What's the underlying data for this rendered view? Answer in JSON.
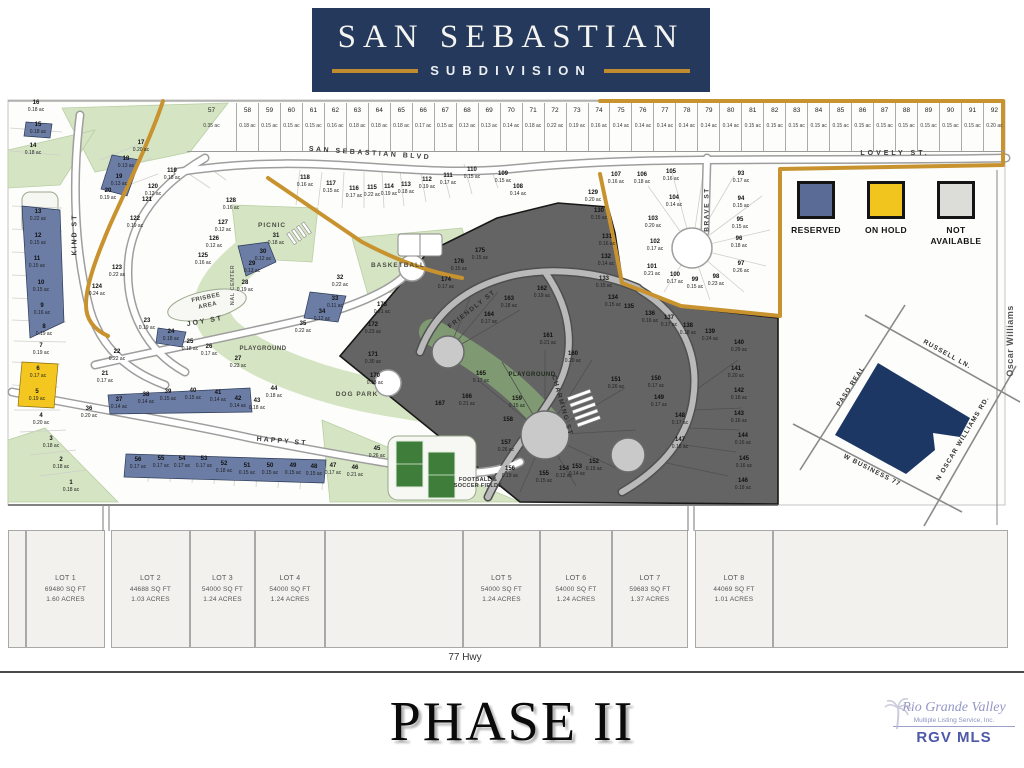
{
  "header": {
    "title": "SAN SEBASTIAN",
    "subtitle": "SUBDIVISION"
  },
  "legend": {
    "items": [
      {
        "label": "RESERVED",
        "color": "#5a6b96"
      },
      {
        "label": "ON HOLD",
        "color": "#f2c51e"
      },
      {
        "label": "NOT AVAILABLE",
        "color": "#dcdcd9"
      }
    ]
  },
  "map": {
    "streets": {
      "san_sebastian": "SAN SEBASTIAN BLVD",
      "lovely": "LOVELY ST.",
      "kind": "KIND ST",
      "joy": "JOY ST",
      "happy": "HAPPY ST",
      "friendly": "FRIENDLY ST",
      "charming": "CHARMING ST",
      "brave": "BRAVE ST",
      "oscar_williams": "Oscar Williams"
    },
    "amenities": {
      "picnic": "PICNIC",
      "center": "NAL CENTER",
      "basketball": "BASKETBALL",
      "frisbee": "FRISBEE AREA",
      "playground_w": "PLAYGROUND",
      "playground_e": "PLAYGROUND",
      "dog_park": "DOG PARK",
      "fields": "FOOTBALL & SOCCER FIELDS"
    },
    "top_lots": [
      {
        "n": 57,
        "ac": "0.35 ac"
      },
      {
        "n": 58,
        "ac": "0.18 ac"
      },
      {
        "n": 59,
        "ac": "0.15 ac"
      },
      {
        "n": 60,
        "ac": "0.15 ac"
      },
      {
        "n": 61,
        "ac": "0.15 ac"
      },
      {
        "n": 62,
        "ac": "0.16 ac"
      },
      {
        "n": 63,
        "ac": "0.18 ac"
      },
      {
        "n": 64,
        "ac": "0.18 ac"
      },
      {
        "n": 65,
        "ac": "0.18 ac"
      },
      {
        "n": 66,
        "ac": "0.17 ac"
      },
      {
        "n": 67,
        "ac": "0.15 ac"
      },
      {
        "n": 68,
        "ac": "0.13 ac"
      },
      {
        "n": 69,
        "ac": "0.13 ac"
      },
      {
        "n": 70,
        "ac": "0.14 ac"
      },
      {
        "n": 71,
        "ac": "0.18 ac"
      },
      {
        "n": 72,
        "ac": "0.22 ac"
      },
      {
        "n": 73,
        "ac": "0.19 ac"
      },
      {
        "n": 74,
        "ac": "0.16 ac"
      },
      {
        "n": 75,
        "ac": "0.14 ac"
      },
      {
        "n": 76,
        "ac": "0.14 ac"
      },
      {
        "n": 77,
        "ac": "0.14 ac"
      },
      {
        "n": 78,
        "ac": "0.14 ac"
      },
      {
        "n": 79,
        "ac": "0.14 ac"
      },
      {
        "n": 80,
        "ac": "0.14 ac"
      },
      {
        "n": 81,
        "ac": "0.15 ac"
      },
      {
        "n": 82,
        "ac": "0.15 ac"
      },
      {
        "n": 83,
        "ac": "0.15 ac"
      },
      {
        "n": 84,
        "ac": "0.15 ac"
      },
      {
        "n": 85,
        "ac": "0.15 ac"
      },
      {
        "n": 86,
        "ac": "0.15 ac"
      },
      {
        "n": 87,
        "ac": "0.15 ac"
      },
      {
        "n": 88,
        "ac": "0.15 ac"
      },
      {
        "n": 89,
        "ac": "0.15 ac"
      },
      {
        "n": 90,
        "ac": "0.15 ac"
      },
      {
        "n": 91,
        "ac": "0.15 ac"
      },
      {
        "n": 92,
        "ac": "0.20 ac"
      }
    ],
    "lots": [
      [
        16,
        "0.18 ac",
        36,
        107,
        "w"
      ],
      [
        15,
        "0.18 ac",
        38,
        129,
        "b"
      ],
      [
        14,
        "0.18 ac",
        33,
        150,
        "w"
      ],
      [
        13,
        "0.22 ac",
        38,
        216,
        "b"
      ],
      [
        12,
        "0.15 ac",
        38,
        240,
        "b"
      ],
      [
        11,
        "0.15 ac",
        37,
        263,
        "b"
      ],
      [
        10,
        "0.15 ac",
        41,
        287,
        "b"
      ],
      [
        9,
        "0.16 ac",
        42,
        310,
        "b"
      ],
      [
        8,
        "0.19 ac",
        44,
        331,
        "w"
      ],
      [
        7,
        "0.19 ac",
        41,
        350,
        "w"
      ],
      [
        6,
        "0.17 ac",
        38,
        373,
        "y"
      ],
      [
        5,
        "0.19 ac",
        37,
        396,
        "y"
      ],
      [
        4,
        "0.20 ac",
        41,
        420,
        "w"
      ],
      [
        3,
        "0.18 ac",
        51,
        443,
        "w"
      ],
      [
        2,
        "0.18 ac",
        61,
        464,
        "w"
      ],
      [
        1,
        "0.18 ac",
        71,
        487,
        "w"
      ],
      [
        17,
        "0.20 ac",
        141,
        147,
        "w"
      ],
      [
        18,
        "0.13 ac",
        126,
        163,
        "b"
      ],
      [
        19,
        "0.13 ac",
        119,
        181,
        "b"
      ],
      [
        20,
        "0.19 ac",
        108,
        195,
        "w"
      ],
      [
        119,
        "0.18 ac",
        172,
        175,
        "w"
      ],
      [
        120,
        "0.12 ac",
        153,
        191,
        "w"
      ],
      [
        121,
        "",
        147,
        204,
        "w"
      ],
      [
        122,
        "0.19 ac",
        135,
        223,
        "w"
      ],
      [
        123,
        "0.22 ac",
        117,
        272,
        "w"
      ],
      [
        124,
        "0.24 ac",
        97,
        291,
        "w"
      ],
      [
        125,
        "0.16 ac",
        203,
        260,
        "w"
      ],
      [
        126,
        "0.12 ac",
        214,
        243,
        "w"
      ],
      [
        127,
        "0.12 ac",
        223,
        227,
        "w"
      ],
      [
        128,
        "0.16 ac",
        231,
        205,
        "w"
      ],
      [
        22,
        "0.22 ac",
        117,
        356,
        "w"
      ],
      [
        21,
        "0.17 ac",
        105,
        378,
        "w"
      ],
      [
        23,
        "0.19 ac",
        147,
        325,
        "w"
      ],
      [
        24,
        "0.18 ac",
        171,
        336,
        "b"
      ],
      [
        25,
        "0.18 ac",
        190,
        346,
        "w"
      ],
      [
        26,
        "0.17 ac",
        209,
        351,
        "w"
      ],
      [
        27,
        "0.23 ac",
        238,
        363,
        "w"
      ],
      [
        28,
        "0.19 ac",
        245,
        287,
        "w"
      ],
      [
        29,
        "0.13 ac",
        252,
        268,
        "b"
      ],
      [
        30,
        "0.12 ac",
        263,
        256,
        "b"
      ],
      [
        31,
        "0.18 ac",
        276,
        240,
        "w"
      ],
      [
        32,
        "0.22 ac",
        340,
        282,
        "w"
      ],
      [
        33,
        "0.11 ac",
        335,
        303,
        "b"
      ],
      [
        34,
        "0.12 ac",
        322,
        316,
        "b"
      ],
      [
        35,
        "0.22 ac",
        303,
        328,
        "w"
      ],
      [
        36,
        "0.20 ac",
        89,
        413,
        "w"
      ],
      [
        37,
        "0.14 ac",
        119,
        404,
        "b"
      ],
      [
        38,
        "0.14 ac",
        146,
        399,
        "b"
      ],
      [
        39,
        "0.15 ac",
        168,
        396,
        "b"
      ],
      [
        40,
        "0.15 ac",
        193,
        395,
        "b"
      ],
      [
        41,
        "0.14 ac",
        218,
        397,
        "b"
      ],
      [
        42,
        "0.14 ac",
        238,
        403,
        "b"
      ],
      [
        43,
        "0.18 ac",
        257,
        405,
        "w"
      ],
      [
        44,
        "0.18 ac",
        274,
        393,
        "w"
      ],
      [
        45,
        "0.26 ac",
        377,
        453,
        "w"
      ],
      [
        46,
        "0.21 ac",
        355,
        472,
        "w"
      ],
      [
        47,
        "0.17 ac",
        333,
        470,
        "w"
      ],
      [
        48,
        "0.15 ac",
        314,
        471,
        "b"
      ],
      [
        49,
        "0.15 ac",
        293,
        470,
        "b"
      ],
      [
        50,
        "0.15 ac",
        270,
        470,
        "b"
      ],
      [
        51,
        "0.15 ac",
        247,
        470,
        "b"
      ],
      [
        52,
        "0.18 ac",
        224,
        468,
        "b"
      ],
      [
        53,
        "0.17 ac",
        204,
        463,
        "b"
      ],
      [
        54,
        "0.17 ac",
        182,
        463,
        "b"
      ],
      [
        55,
        "0.17 ac",
        161,
        463,
        "b"
      ],
      [
        56,
        "0.17 ac",
        138,
        464,
        "b"
      ],
      [
        118,
        "0.16 ac",
        305,
        182,
        "w"
      ],
      [
        117,
        "0.15 ac",
        331,
        188,
        "w"
      ],
      [
        116,
        "0.17 ac",
        354,
        193,
        "w"
      ],
      [
        115,
        "0.22 ac",
        372,
        192,
        "w"
      ],
      [
        114,
        "0.19 ac",
        389,
        191,
        "w"
      ],
      [
        113,
        "0.18 ac",
        406,
        189,
        "w"
      ],
      [
        112,
        "0.19 ac",
        427,
        184,
        "w"
      ],
      [
        111,
        "0.17 ac",
        448,
        180,
        "w"
      ],
      [
        110,
        "0.15 ac",
        472,
        174,
        "w"
      ],
      [
        109,
        "0.15 ac",
        503,
        178,
        "w"
      ],
      [
        108,
        "0.14 ac",
        518,
        191,
        "w"
      ],
      [
        129,
        "0.20 ac",
        593,
        197,
        "w"
      ],
      [
        130,
        "0.15 ac",
        599,
        215,
        "d"
      ],
      [
        131,
        "0.16 ac",
        607,
        241,
        "d"
      ],
      [
        132,
        "0.14 ac",
        606,
        261,
        "d"
      ],
      [
        133,
        "0.15 ac",
        604,
        283,
        "d"
      ],
      [
        134,
        "0.15 ac",
        613,
        302,
        "d"
      ],
      [
        135,
        "",
        629,
        311,
        "d"
      ],
      [
        136,
        "0.16 ac",
        650,
        318,
        "d"
      ],
      [
        137,
        "0.17 ac",
        669,
        322,
        "d"
      ],
      [
        138,
        "0.18 ac",
        688,
        330,
        "d"
      ],
      [
        139,
        "0.24 ac",
        710,
        336,
        "d"
      ],
      [
        140,
        "0.29 ac",
        739,
        347,
        "d"
      ],
      [
        141,
        "0.20 ac",
        736,
        373,
        "d"
      ],
      [
        142,
        "0.18 ac",
        739,
        395,
        "d"
      ],
      [
        143,
        "0.16 ac",
        739,
        418,
        "d"
      ],
      [
        144,
        "0.16 ac",
        743,
        440,
        "d"
      ],
      [
        145,
        "0.16 ac",
        744,
        463,
        "d"
      ],
      [
        146,
        "0.18 ac",
        743,
        485,
        "d"
      ],
      [
        147,
        "0.18 ac",
        680,
        444,
        "d"
      ],
      [
        148,
        "0.17 ac",
        680,
        420,
        "d"
      ],
      [
        149,
        "0.17 ac",
        659,
        402,
        "d"
      ],
      [
        150,
        "0.17 ac",
        656,
        383,
        "d"
      ],
      [
        151,
        "0.26 ac",
        616,
        384,
        "d"
      ],
      [
        152,
        "0.15 ac",
        594,
        466,
        "d"
      ],
      [
        153,
        "0.14 ac",
        577,
        471,
        "d"
      ],
      [
        154,
        "0.12 ac",
        564,
        473,
        "d"
      ],
      [
        155,
        "0.15 ac",
        544,
        478,
        "d"
      ],
      [
        156,
        "0.19 ac",
        510,
        473,
        "d"
      ],
      [
        157,
        "0.26 ac",
        506,
        447,
        "d"
      ],
      [
        158,
        "",
        508,
        424,
        "d"
      ],
      [
        159,
        "0.15 ac",
        517,
        403,
        "d"
      ],
      [
        160,
        "0.20 ac",
        573,
        358,
        "d"
      ],
      [
        161,
        "0.21 ac",
        548,
        340,
        "d"
      ],
      [
        162,
        "0.19 ac",
        542,
        293,
        "d"
      ],
      [
        163,
        "0.18 ac",
        509,
        303,
        "d"
      ],
      [
        164,
        "0.17 ac",
        489,
        319,
        "d"
      ],
      [
        165,
        "0.17 ac",
        481,
        378,
        "d"
      ],
      [
        166,
        "0.21 ac",
        467,
        401,
        "d"
      ],
      [
        167,
        "",
        440,
        408,
        "d"
      ],
      [
        170,
        "0.18 ac",
        375,
        380,
        "d"
      ],
      [
        171,
        "0.30 ac",
        373,
        359,
        "d"
      ],
      [
        172,
        "0.23 ac",
        373,
        329,
        "d"
      ],
      [
        173,
        "0.21 ac",
        382,
        309,
        "d"
      ],
      [
        174,
        "0.17 ac",
        446,
        284,
        "d"
      ],
      [
        175,
        "0.15 ac",
        480,
        255,
        "d"
      ],
      [
        176,
        "0.15 ac",
        459,
        266,
        "d"
      ],
      [
        93,
        "0.17 ac",
        741,
        178,
        "w"
      ],
      [
        94,
        "0.15 ac",
        741,
        203,
        "w"
      ],
      [
        95,
        "0.15 ac",
        740,
        224,
        "w"
      ],
      [
        96,
        "0.18 ac",
        739,
        243,
        "w"
      ],
      [
        97,
        "0.26 ac",
        741,
        268,
        "w"
      ],
      [
        98,
        "0.23 ac",
        716,
        281,
        "w"
      ],
      [
        99,
        "0.15 ac",
        695,
        284,
        "w"
      ],
      [
        100,
        "0.17 ac",
        675,
        279,
        "w"
      ],
      [
        101,
        "0.21 ac",
        652,
        271,
        "w"
      ],
      [
        102,
        "0.17 ac",
        655,
        246,
        "w"
      ],
      [
        103,
        "0.20 ac",
        653,
        223,
        "w"
      ],
      [
        104,
        "0.14 ac",
        674,
        202,
        "w"
      ],
      [
        105,
        "0.16 ac",
        671,
        176,
        "w"
      ],
      [
        106,
        "0.18 ac",
        642,
        179,
        "w"
      ],
      [
        107,
        "0.16 ac",
        616,
        179,
        "w"
      ]
    ]
  },
  "inset": {
    "paso": "PASO REAL",
    "russell": "RUSSELL LN.",
    "business": "W BUSINESS 77",
    "oscar": "N OSCAR WILLIAMS RD."
  },
  "bottom_lots": [
    {
      "name": "LOT 1",
      "sqft": "69480 SQ FT",
      "acres": "1.60 ACRES"
    },
    {
      "name": "LOT 2",
      "sqft": "44688 SQ FT",
      "acres": "1.03 ACRES"
    },
    {
      "name": "LOT 3",
      "sqft": "54000 SQ FT",
      "acres": "1.24 ACRES"
    },
    {
      "name": "LOT 4",
      "sqft": "54000 SQ FT",
      "acres": "1.24 ACRES"
    },
    {
      "name": "LOT 5",
      "sqft": "54000 SQ FT",
      "acres": "1.24 ACRES"
    },
    {
      "name": "LOT 6",
      "sqft": "54000 SQ FT",
      "acres": "1.24 ACRES"
    },
    {
      "name": "LOT 7",
      "sqft": "59683 SQ FT",
      "acres": "1.37 ACRES"
    },
    {
      "name": "LOT 8",
      "sqft": "44069 SQ FT",
      "acres": "1.01 ACRES"
    }
  ],
  "highway": "77 Hwy",
  "phase": "PHASE II",
  "mls": {
    "name": "Rio Grande Valley",
    "service": "Multiple Listing Service, Inc.",
    "abbr": "RGV MLS"
  }
}
